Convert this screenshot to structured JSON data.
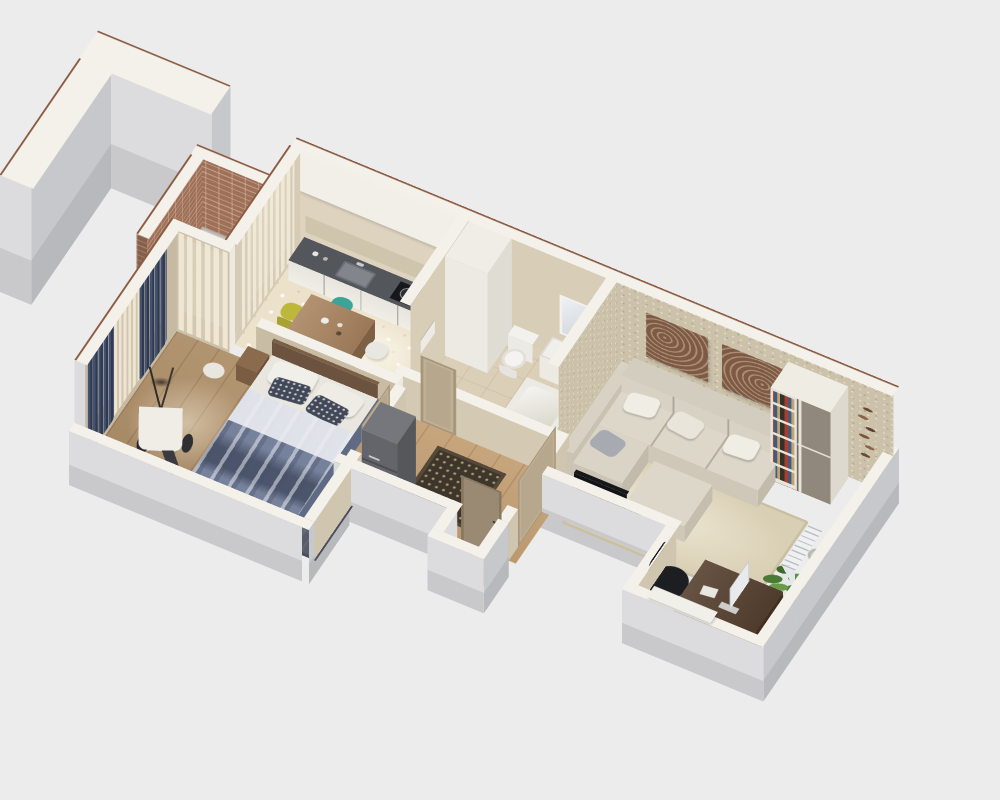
{
  "scene": {
    "title": "3D isometric apartment floor plan render",
    "view": "cutaway dollhouse from south-east above",
    "background": "#ececec"
  },
  "palette": {
    "bg": "#ececec",
    "wall_ext": "#dcdcde",
    "wall_ext_dark": "#c7c8cb",
    "wall_top": "#f4f1ea",
    "trim_brown": "#8a5a42",
    "wall_int_tan": "#d2c7b0",
    "wallpaper_living": "#ccc1a9",
    "brick": "#9e7058",
    "wood_hall": "#c6a277",
    "wood_bed": "#b2926b",
    "wood_living": "#c29d74",
    "tile_kitchen": "#ece2cb",
    "floor_bath": "#dbcfb8",
    "counter_top": "#53565b",
    "cabinet_white": "#f0eee7",
    "cooktop_black": "#17181b",
    "dining_wood": "#a8835f",
    "chair_yellow": "#bdb73c",
    "chair_teal": "#3aa39a",
    "sofa_cream": "#d8d2c4",
    "rug_living": "#d9cfb4",
    "rug_bedroom": "#565c69",
    "doormat": "#3e362b",
    "curtain_blue": "#3e4a63",
    "curtain_sheer": "#ece4d0",
    "duvet_blue": "#76819b",
    "pillow_dark": "#424857",
    "art_brown": "#7b5b45",
    "shelf_doors": "#8f887b",
    "desk_wood": "#5a4433",
    "chair_black": "#1d1e22",
    "monitor_white": "#e9eaec",
    "radiator_white": "#eef0f1",
    "plant_green": "#4a7a35",
    "gray_cabinet": "#63656a",
    "tub_white": "#eceae4",
    "door_tan": "#b7a78c"
  },
  "rooms": [
    {
      "id": "bedroom",
      "label": "Bedroom",
      "floor": "wood",
      "furniture": [
        "double-bed",
        "headboard",
        "nightstand",
        "nightstand",
        "bedroom-rug",
        "exercise-bike",
        "floor-vase-with-branches",
        "blue-curtains",
        "sheer-curtains"
      ]
    },
    {
      "id": "kitchen-dining",
      "label": "Kitchen / Dining",
      "floor": "cream tile with dots",
      "furniture": [
        "kitchen-counter",
        "sink",
        "cooktop",
        "white-soffit",
        "dining-table",
        "yellow-chair",
        "teal-chair",
        "white-chair",
        "white-chair",
        "window-sheer-curtains"
      ]
    },
    {
      "id": "hallway",
      "label": "Hallway / Entrance",
      "floor": "wood",
      "furniture": [
        "patterned-doormat",
        "gray-wardrobe-cabinet",
        "entrance-door",
        "bedroom-door"
      ]
    },
    {
      "id": "bathroom",
      "label": "Bathroom",
      "floor": "beige tile",
      "furniture": [
        "toilet",
        "vanity-sink",
        "mirror",
        "bathtub",
        "shower-column",
        "bathroom-door",
        "duct-closet"
      ]
    },
    {
      "id": "living-room",
      "label": "Living Room",
      "floor": "wood",
      "furniture": [
        "corner-sofa",
        "ottoman",
        "area-rug",
        "tv-console",
        "tv",
        "wall-art-panel",
        "wall-art-panel",
        "bookshelf-unit",
        "leaf-wall-decor",
        "potted-fern",
        "desk",
        "office-chair",
        "monitor",
        "radiator",
        "window-sill"
      ]
    },
    {
      "id": "balcony",
      "label": "Balcony",
      "floor": "concrete",
      "furniture": [
        "brick-parapet"
      ]
    }
  ]
}
